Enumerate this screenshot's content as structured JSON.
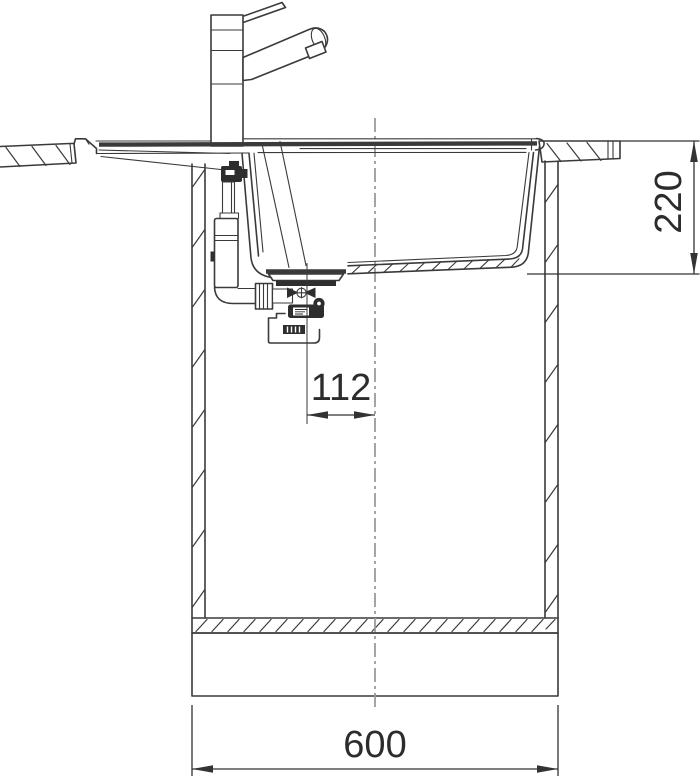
{
  "drawing": {
    "title": "kitchen-sink-installation-section",
    "dimensions": {
      "depth": {
        "label": "220",
        "orientation": "vertical"
      },
      "drain_offset": {
        "label": "112",
        "orientation": "horizontal"
      },
      "width": {
        "label": "600",
        "orientation": "horizontal"
      }
    },
    "colors": {
      "line_color": "#3a3a3a",
      "dark_fill": "#2e2e2e",
      "centerline_color": "#9b9b9b",
      "dimension_text_color": "#2c2c2c",
      "background": "#ffffff"
    },
    "components": [
      "faucet-mixer",
      "mixer-lever",
      "mixer-spout",
      "countertop-left",
      "countertop-right",
      "sink-rim",
      "sink-bowl",
      "overflow-assembly",
      "drain-assembly",
      "siphon-outlet",
      "base-cabinet",
      "cabinet-bottom-panel",
      "plinth",
      "vertical-centerline"
    ]
  }
}
